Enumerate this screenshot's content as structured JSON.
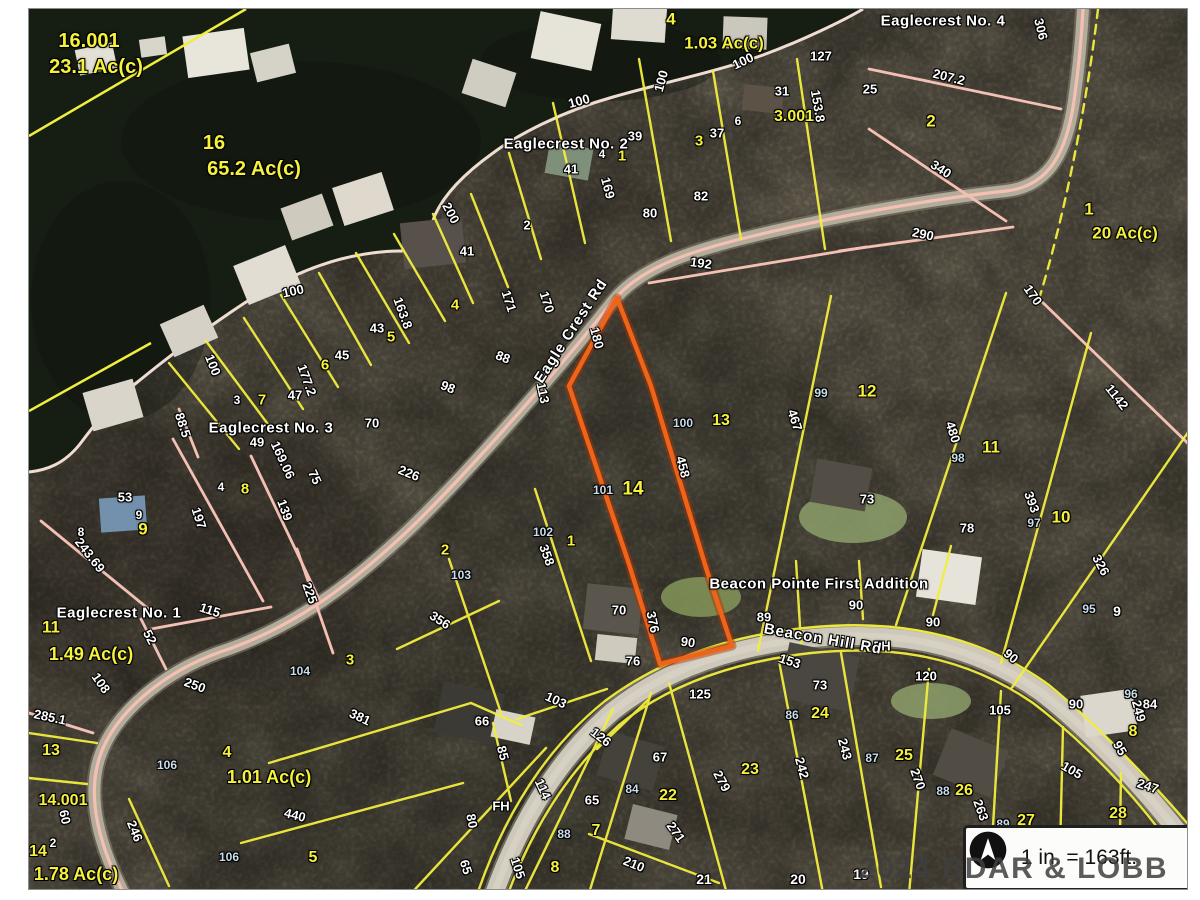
{
  "map": {
    "watermark": "2024 BDAR & LOBB MLS",
    "scale_box": {
      "text": "1 in. = 163ft.",
      "icon": "north-arrow-icon"
    },
    "subject_parcel": {
      "lot": "14",
      "outline_color": "#ee6418"
    },
    "label_colors": {
      "w": "#ffffff",
      "y": "#f6f13d",
      "b": "#c9ddeb"
    },
    "roads": [
      {
        "name": "Eagle Crest Rd",
        "x": 570,
        "y": 330,
        "rot": -57
      },
      {
        "name": "Beacon Hill Rd",
        "x": 822,
        "y": 638,
        "rot": 10
      }
    ],
    "subdivisions": [
      {
        "name": "Eaglecrest No. 4",
        "x": 942,
        "y": 20
      },
      {
        "name": "Eaglecrest No. 2",
        "x": 565,
        "y": 143
      },
      {
        "name": "Eaglecrest No. 3",
        "x": 270,
        "y": 427
      },
      {
        "name": "Eaglecrest No. 1",
        "x": 118,
        "y": 612
      },
      {
        "name": "Beacon Pointe First Addition",
        "x": 818,
        "y": 583
      }
    ],
    "labels": [
      [
        "16.001",
        88,
        40,
        "y",
        20,
        0
      ],
      [
        "23.1 Ac(c)",
        95,
        66,
        "y",
        20,
        0
      ],
      [
        "16",
        213,
        142,
        "y",
        20,
        0
      ],
      [
        "65.2 Ac(c)",
        253,
        168,
        "y",
        20,
        0
      ],
      [
        "4",
        670,
        18,
        "y",
        17,
        0
      ],
      [
        "1.03 Ac(c)",
        723,
        42,
        "y",
        17,
        0
      ],
      [
        "100",
        578,
        100,
        "w",
        13,
        -15
      ],
      [
        "100",
        660,
        80,
        "w",
        13,
        -75
      ],
      [
        "100",
        742,
        60,
        "w",
        13,
        -25
      ],
      [
        "127",
        820,
        55,
        "w",
        13,
        0
      ],
      [
        "31",
        781,
        90,
        "w",
        13,
        0
      ],
      [
        "6",
        737,
        120,
        "w",
        12,
        0
      ],
      [
        "3.001",
        793,
        116,
        "y",
        16,
        0
      ],
      [
        "39",
        634,
        135,
        "w",
        13,
        0
      ],
      [
        "3",
        698,
        140,
        "y",
        15,
        0
      ],
      [
        "37",
        716,
        132,
        "w",
        13,
        0
      ],
      [
        "1",
        621,
        155,
        "y",
        15,
        0
      ],
      [
        "4",
        601,
        153,
        "w",
        12,
        0
      ],
      [
        "41",
        570,
        168,
        "w",
        13,
        0
      ],
      [
        "153.8",
        817,
        105,
        "w",
        13,
        80
      ],
      [
        "82",
        700,
        195,
        "w",
        13,
        0
      ],
      [
        "80",
        649,
        212,
        "w",
        13,
        0
      ],
      [
        "169",
        607,
        187,
        "w",
        13,
        75
      ],
      [
        "25",
        869,
        88,
        "w",
        13,
        0
      ],
      [
        "207.2",
        948,
        76,
        "w",
        13,
        14
      ],
      [
        "306",
        1040,
        28,
        "w",
        13,
        76
      ],
      [
        "2",
        930,
        120,
        "y",
        17,
        0
      ],
      [
        "340",
        940,
        168,
        "w",
        13,
        33
      ],
      [
        "290",
        922,
        233,
        "w",
        13,
        12
      ],
      [
        "1",
        1088,
        208,
        "y",
        17,
        0
      ],
      [
        "20 Ac(c)",
        1124,
        232,
        "y",
        17,
        0
      ],
      [
        "170",
        1032,
        294,
        "w",
        13,
        55
      ],
      [
        "192",
        700,
        262,
        "w",
        13,
        8
      ],
      [
        "200",
        450,
        212,
        "w",
        13,
        62
      ],
      [
        "2",
        526,
        224,
        "w",
        13,
        0
      ],
      [
        "41",
        466,
        250,
        "w",
        13,
        0
      ],
      [
        "171",
        508,
        300,
        "w",
        13,
        72
      ],
      [
        "170",
        546,
        301,
        "w",
        13,
        72
      ],
      [
        "4",
        454,
        304,
        "y",
        15,
        0
      ],
      [
        "88",
        502,
        356,
        "w",
        13,
        22
      ],
      [
        "98",
        447,
        386,
        "w",
        13,
        22
      ],
      [
        "113",
        542,
        392,
        "w",
        13,
        78
      ],
      [
        "180",
        596,
        337,
        "w",
        13,
        75
      ],
      [
        "100",
        292,
        290,
        "w",
        13,
        -12
      ],
      [
        "100",
        212,
        364,
        "w",
        13,
        68
      ],
      [
        "163.8",
        402,
        312,
        "w",
        13,
        70
      ],
      [
        "43",
        376,
        327,
        "w",
        13,
        0
      ],
      [
        "5",
        390,
        336,
        "y",
        15,
        0
      ],
      [
        "45",
        341,
        354,
        "w",
        13,
        0
      ],
      [
        "6",
        324,
        364,
        "y",
        15,
        0
      ],
      [
        "177.2",
        306,
        379,
        "w",
        13,
        70
      ],
      [
        "47",
        294,
        394,
        "w",
        13,
        0
      ],
      [
        "7",
        261,
        399,
        "y",
        15,
        0
      ],
      [
        "3",
        236,
        399,
        "w",
        12,
        0
      ],
      [
        "49",
        256,
        441,
        "w",
        13,
        0
      ],
      [
        "169.06",
        282,
        459,
        "w",
        13,
        65
      ],
      [
        "75",
        314,
        476,
        "w",
        13,
        65
      ],
      [
        "88.5",
        182,
        424,
        "w",
        13,
        72
      ],
      [
        "8",
        244,
        488,
        "y",
        15,
        0
      ],
      [
        "4",
        220,
        486,
        "w",
        12,
        0
      ],
      [
        "70",
        371,
        422,
        "w",
        13,
        0
      ],
      [
        "226",
        408,
        472,
        "w",
        13,
        22
      ],
      [
        "139",
        284,
        509,
        "w",
        13,
        70
      ],
      [
        "53",
        124,
        496,
        "w",
        13,
        0
      ],
      [
        "9",
        138,
        514,
        "w",
        12,
        0
      ],
      [
        "9",
        142,
        528,
        "y",
        17,
        0
      ],
      [
        "8",
        80,
        531,
        "w",
        12,
        0
      ],
      [
        "243.69",
        89,
        554,
        "w",
        13,
        52
      ],
      [
        "197",
        198,
        517,
        "w",
        13,
        72
      ],
      [
        "115",
        209,
        609,
        "w",
        13,
        18
      ],
      [
        "52",
        149,
        636,
        "w",
        13,
        62
      ],
      [
        "11",
        50,
        626,
        "y",
        17,
        0
      ],
      [
        "1.49 Ac(c)",
        90,
        653,
        "y",
        18,
        0
      ],
      [
        "225",
        309,
        592,
        "w",
        13,
        70
      ],
      [
        "108",
        100,
        682,
        "w",
        13,
        55
      ],
      [
        "250",
        194,
        684,
        "w",
        13,
        20
      ],
      [
        "285.1",
        49,
        716,
        "w",
        13,
        12
      ],
      [
        "13",
        50,
        750,
        "y",
        16,
        0
      ],
      [
        "14.001",
        62,
        800,
        "y",
        16,
        0
      ],
      [
        "60",
        64,
        816,
        "w",
        13,
        78
      ],
      [
        "2",
        52,
        842,
        "w",
        12,
        0
      ],
      [
        "14",
        37,
        851,
        "y",
        16,
        0
      ],
      [
        "1.78 Ac(c)",
        75,
        873,
        "y",
        18,
        0
      ],
      [
        "246",
        134,
        830,
        "w",
        13,
        68
      ],
      [
        "106",
        166,
        764,
        "b",
        12,
        0
      ],
      [
        "106",
        228,
        856,
        "b",
        12,
        0
      ],
      [
        "4",
        226,
        752,
        "y",
        16,
        0
      ],
      [
        "1.01 Ac(c)",
        268,
        776,
        "y",
        18,
        0
      ],
      [
        "104",
        299,
        670,
        "b",
        12,
        0
      ],
      [
        "3",
        349,
        659,
        "y",
        15,
        0
      ],
      [
        "440",
        294,
        814,
        "w",
        13,
        14
      ],
      [
        "381",
        359,
        716,
        "w",
        13,
        25
      ],
      [
        "5",
        312,
        857,
        "y",
        16,
        0
      ],
      [
        "2",
        444,
        549,
        "y",
        15,
        0
      ],
      [
        "103",
        460,
        574,
        "b",
        12,
        0
      ],
      [
        "356",
        439,
        619,
        "w",
        13,
        33
      ],
      [
        "102",
        542,
        531,
        "b",
        12,
        0
      ],
      [
        "1",
        570,
        540,
        "y",
        15,
        0
      ],
      [
        "358",
        546,
        554,
        "w",
        13,
        70
      ],
      [
        "101",
        602,
        489,
        "b",
        12,
        0
      ],
      [
        "14",
        632,
        488,
        "y",
        19,
        0
      ],
      [
        "100",
        682,
        422,
        "b",
        12,
        0
      ],
      [
        "13",
        720,
        420,
        "y",
        16,
        0
      ],
      [
        "458",
        682,
        466,
        "w",
        13,
        75
      ],
      [
        "467",
        794,
        419,
        "w",
        13,
        72
      ],
      [
        "99",
        820,
        392,
        "b",
        12,
        0
      ],
      [
        "12",
        866,
        390,
        "y",
        17,
        0
      ],
      [
        "480",
        952,
        431,
        "w",
        13,
        72
      ],
      [
        "98",
        957,
        457,
        "b",
        12,
        0
      ],
      [
        "11",
        990,
        446,
        "y",
        17,
        0
      ],
      [
        "73",
        866,
        498,
        "w",
        13,
        0
      ],
      [
        "78",
        966,
        527,
        "w",
        13,
        0
      ],
      [
        "393",
        1031,
        501,
        "w",
        13,
        70
      ],
      [
        "97",
        1033,
        522,
        "b",
        12,
        0
      ],
      [
        "10",
        1060,
        516,
        "y",
        17,
        0
      ],
      [
        "1142",
        1116,
        396,
        "w",
        13,
        52
      ],
      [
        "326",
        1100,
        564,
        "w",
        13,
        62
      ],
      [
        "90",
        687,
        641,
        "w",
        13,
        8
      ],
      [
        "70",
        618,
        609,
        "w",
        13,
        0
      ],
      [
        "376",
        652,
        621,
        "w",
        13,
        78
      ],
      [
        "76",
        632,
        660,
        "w",
        13,
        0
      ],
      [
        "89",
        763,
        616,
        "w",
        13,
        0
      ],
      [
        "90",
        855,
        604,
        "w",
        13,
        0
      ],
      [
        "90",
        932,
        621,
        "w",
        13,
        0
      ],
      [
        "90",
        1010,
        655,
        "w",
        13,
        40
      ],
      [
        "90",
        1075,
        703,
        "w",
        13,
        0
      ],
      [
        "FH",
        881,
        645,
        "w",
        13,
        0
      ],
      [
        "FH",
        500,
        805,
        "w",
        13,
        0
      ],
      [
        "153",
        789,
        660,
        "w",
        13,
        18
      ],
      [
        "73",
        819,
        684,
        "w",
        13,
        0
      ],
      [
        "24",
        819,
        713,
        "y",
        16,
        0
      ],
      [
        "86",
        791,
        714,
        "b",
        12,
        0
      ],
      [
        "125",
        699,
        693,
        "w",
        13,
        0
      ],
      [
        "126",
        600,
        736,
        "w",
        13,
        38
      ],
      [
        "67",
        659,
        756,
        "w",
        13,
        0
      ],
      [
        "84",
        631,
        788,
        "b",
        12,
        0
      ],
      [
        "22",
        667,
        795,
        "y",
        16,
        0
      ],
      [
        "23",
        749,
        769,
        "y",
        16,
        0
      ],
      [
        "279",
        721,
        780,
        "w",
        13,
        62
      ],
      [
        "242",
        801,
        767,
        "w",
        13,
        75
      ],
      [
        "243",
        844,
        748,
        "w",
        13,
        75
      ],
      [
        "87",
        871,
        757,
        "b",
        12,
        0
      ],
      [
        "25",
        903,
        755,
        "y",
        16,
        0
      ],
      [
        "66",
        481,
        720,
        "w",
        13,
        0
      ],
      [
        "103",
        555,
        699,
        "w",
        13,
        25
      ],
      [
        "85",
        502,
        752,
        "w",
        13,
        75
      ],
      [
        "80",
        471,
        820,
        "w",
        13,
        80
      ],
      [
        "65",
        465,
        866,
        "w",
        13,
        72
      ],
      [
        "105",
        517,
        867,
        "w",
        13,
        72
      ],
      [
        "114",
        542,
        788,
        "w",
        13,
        65
      ],
      [
        "65",
        591,
        799,
        "w",
        13,
        0
      ],
      [
        "7",
        595,
        830,
        "y",
        16,
        0
      ],
      [
        "88",
        563,
        833,
        "b",
        12,
        0
      ],
      [
        "8",
        554,
        867,
        "y",
        16,
        0
      ],
      [
        "210",
        633,
        863,
        "w",
        13,
        22
      ],
      [
        "271",
        675,
        831,
        "w",
        13,
        55
      ],
      [
        "21",
        703,
        878,
        "w",
        14,
        0
      ],
      [
        "20",
        797,
        878,
        "w",
        14,
        0
      ],
      [
        "19",
        860,
        873,
        "w",
        14,
        0
      ],
      [
        "120",
        925,
        675,
        "w",
        13,
        0
      ],
      [
        "105",
        999,
        709,
        "w",
        13,
        0
      ],
      [
        "105",
        1071,
        769,
        "w",
        13,
        30
      ],
      [
        "95",
        1088,
        608,
        "b",
        12,
        0
      ],
      [
        "9",
        1116,
        610,
        "w",
        14,
        0
      ],
      [
        "96",
        1130,
        693,
        "b",
        12,
        0
      ],
      [
        "84",
        1149,
        703,
        "w",
        13,
        0
      ],
      [
        "249",
        1138,
        710,
        "w",
        13,
        75
      ],
      [
        "8",
        1132,
        731,
        "y",
        16,
        0
      ],
      [
        "95",
        1119,
        747,
        "w",
        13,
        60
      ],
      [
        "247",
        1147,
        785,
        "w",
        13,
        18
      ],
      [
        "270",
        917,
        778,
        "w",
        13,
        70
      ],
      [
        "88",
        942,
        790,
        "b",
        12,
        0
      ],
      [
        "26",
        963,
        790,
        "y",
        16,
        0
      ],
      [
        "263",
        980,
        809,
        "w",
        13,
        70
      ],
      [
        "27",
        1025,
        820,
        "y",
        16,
        0
      ],
      [
        "89",
        1002,
        823,
        "b",
        12,
        0
      ],
      [
        "28",
        1117,
        813,
        "y",
        16,
        0
      ]
    ]
  }
}
